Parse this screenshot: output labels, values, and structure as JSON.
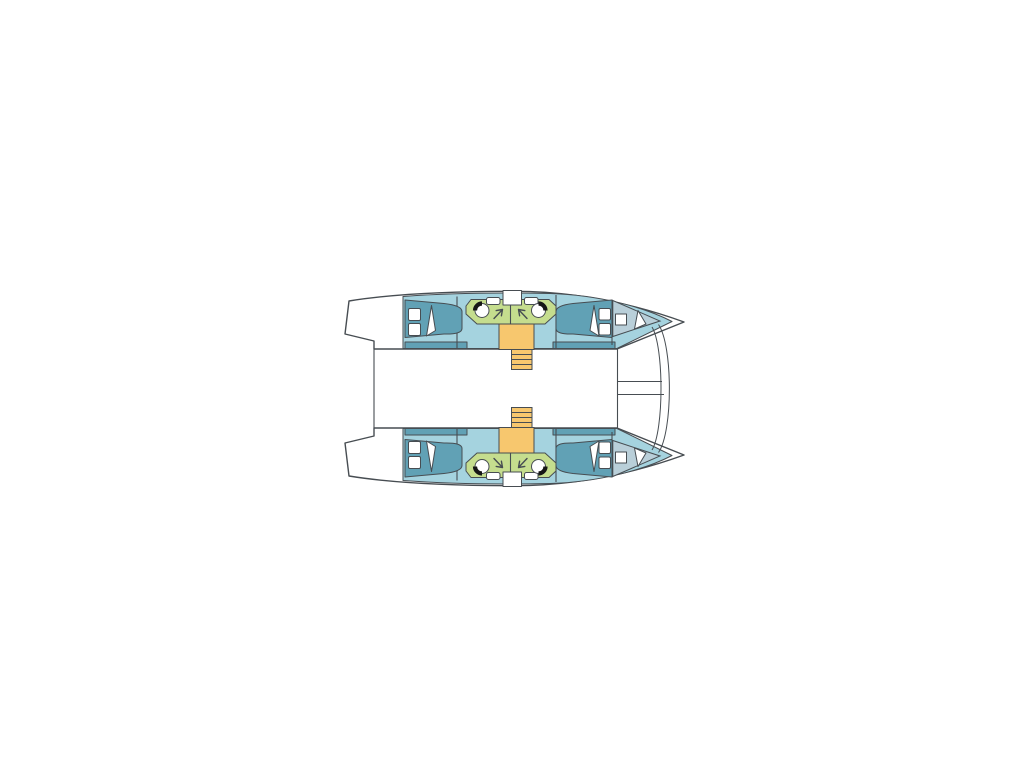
{
  "colors": {
    "background": "#ffffff",
    "outline": "#474d52",
    "hull_fill": "#ffffff",
    "cabin_sole": "#a5d3df",
    "berth": "#61a1b5",
    "forepeak": "#b9cfd9",
    "heads": "#c5dd8e",
    "stairs": "#f7c76e",
    "fixture": "#ffffff",
    "toilet_seat": "#161616"
  },
  "diagram": {
    "type": "floor-plan",
    "label": "Catamaran yacht deck layout plan, bow to the right",
    "orientation": "bow-right",
    "hulls": [
      {
        "name": "port-hull",
        "position": "top",
        "rooms": [
          {
            "name": "aft-double-cabin",
            "berths": 1,
            "pillows": 2
          },
          {
            "name": "heads-compartment",
            "toilets": 2,
            "sinks": 2,
            "entry_arrows": 2
          },
          {
            "name": "forward-double-cabin",
            "berths": 1,
            "pillows": 2
          },
          {
            "name": "forepeak",
            "hatches": 1
          }
        ],
        "stairs": {
          "treads": 4
        }
      },
      {
        "name": "starboard-hull",
        "position": "bottom",
        "rooms": [
          {
            "name": "aft-double-cabin",
            "berths": 1,
            "pillows": 2
          },
          {
            "name": "heads-compartment",
            "toilets": 2,
            "sinks": 2,
            "entry_arrows": 2
          },
          {
            "name": "forward-double-cabin",
            "berths": 1,
            "pillows": 2
          },
          {
            "name": "forepeak",
            "hatches": 1
          }
        ],
        "stairs": {
          "treads": 4
        }
      }
    ],
    "foredeck": {
      "trampoline_lashings": 2,
      "crossbeam_lines": 2
    },
    "stern": {
      "swim_platforms": 2
    }
  }
}
